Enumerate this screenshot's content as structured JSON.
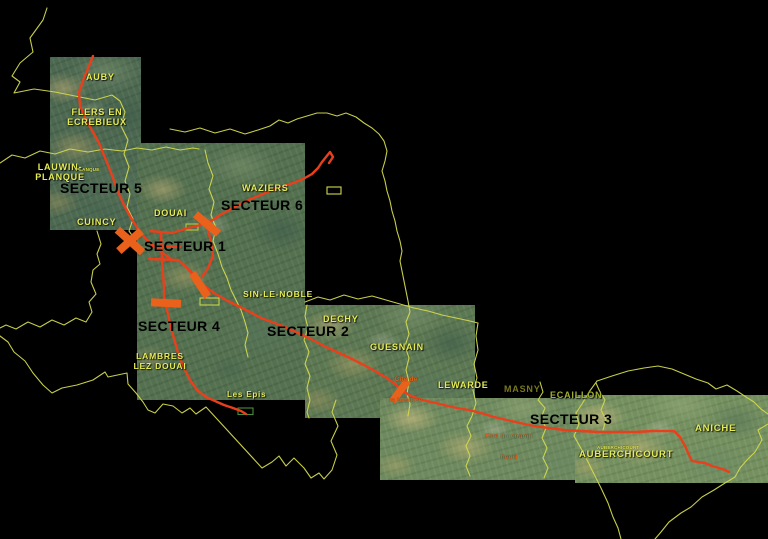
{
  "map": {
    "type": "satellite-route-sector-map",
    "background_color": "#000000",
    "colors": {
      "commune_boundary": "#d2d84e",
      "tram_route": "#e8401c",
      "sector_break_marker": "#ea611c",
      "commune_label_text": "#e6ec55",
      "sector_label_text": "#000000",
      "cite_label_text": "#e4641e",
      "masny_label_text": "#77771f",
      "ecaillon_label_text": "#a2b031",
      "site_outline": "#d2d84e"
    },
    "sector_labels": {
      "s1": "SECTEUR 1",
      "s2": "SECTEUR 2",
      "s3": "SECTEUR 3",
      "s4": "SECTEUR 4",
      "s5": "SECTEUR 5",
      "s6": "SECTEUR 6"
    },
    "commune_labels": {
      "auby": "AUBY",
      "flers_line1": "FLERS EN",
      "flers_line2": "ECREBIEUX",
      "lauwin_line1": "LAUWIN-",
      "lauwin_line2": "PLANQUE",
      "lauwin_small": "PLANQUE",
      "cuincy": "CUINCY",
      "douai": "DOUAI",
      "waziers": "WAZIERS",
      "sin_le_noble": "SIN-LE-NOBLE",
      "dechy": "DECHY",
      "guesnain": "GUESNAIN",
      "lewarde": "LEWARDE",
      "lambres_line1": "LAMBRES",
      "lambres_line2": "LEZ DOUAI",
      "masny": "MASNY",
      "ecaillon": "ECAILLON",
      "aniche": "ANICHE",
      "auberchicourt": "AUBERCHICOURT",
      "auberchicourt_small": "AUBERCHICOURT"
    },
    "site_labels": {
      "les_epis": "Les Epis",
      "cite_balance_line1": "Cité de",
      "cite_balance_line2": "la balance",
      "cite_champ_line1": "Cité du champ",
      "cite_champ_line2": "fleuri"
    }
  }
}
